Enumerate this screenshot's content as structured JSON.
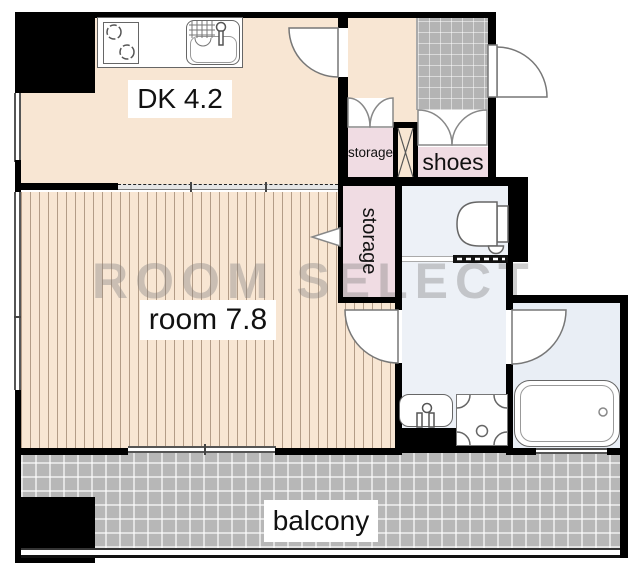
{
  "plan": {
    "watermark": "ROOM SELECT",
    "rooms": {
      "dk": {
        "label": "DK 4.2"
      },
      "room": {
        "label": "room 7.8"
      },
      "balcony": {
        "label": "balcony"
      },
      "storage_hall": {
        "label": "storage"
      },
      "storage_room": {
        "label": "storage"
      },
      "shoes": {
        "label": "shoes"
      }
    },
    "colors": {
      "floor_beige": "#f8e6d3",
      "floor_pink": "#f0dce3",
      "floor_wet": "#edf1f7",
      "floor_bath": "#e9eef5",
      "tile_gray": "#b4b4b4",
      "balcony_gray": "#b7b7b7",
      "wall": "#000000",
      "label_text": "#111111",
      "watermark": "rgba(125,125,125,0.38)"
    }
  }
}
